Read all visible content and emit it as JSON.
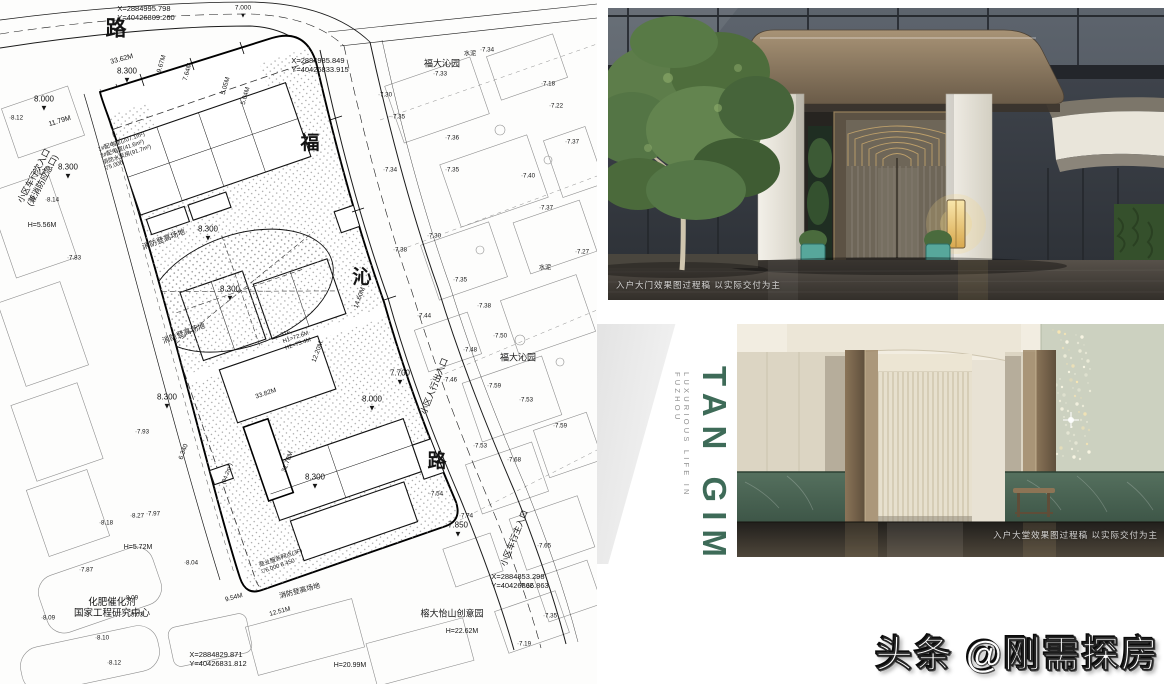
{
  "colors": {
    "brand_green": "#3E6B58",
    "canopy_bronze": "#8a7660",
    "marble_green": "#4a6454",
    "planter_teal": "#57a79b",
    "lamp_glow": "#f0d48a",
    "tree_green": "#5d7d4a"
  },
  "watermark": {
    "text": "头条 @刚需探房"
  },
  "brand": {
    "title": "TAN GIM",
    "subtitle": "LUXURIOUS LIFE IN FUZHOU"
  },
  "entrance_render": {
    "caption": "入户大门效果图过程稿 以实际交付为主"
  },
  "lobby_render": {
    "caption": "入户大堂效果图过程稿 以实际交付为主"
  },
  "site_plan": {
    "labels": [
      {
        "text": "X=2884995.798\nY=40426809.260",
        "x": 146,
        "y": 14,
        "size": 7.5,
        "align": "left"
      },
      {
        "text": "路",
        "x": 116,
        "y": 30,
        "size": 21,
        "bold": true,
        "name": "road-name-top"
      },
      {
        "text": "7.000\n▼",
        "x": 243,
        "y": 12,
        "size": 6.5
      },
      {
        "text": "小区车行次入口\n(兼消防应急口)",
        "x": 38,
        "y": 178,
        "rot": -62,
        "size": 8.5,
        "name": "entrance-secondary-vehicle"
      },
      {
        "text": "8.300\n▼",
        "x": 127,
        "y": 76,
        "size": 8
      },
      {
        "text": "8.000\n▼",
        "x": 44,
        "y": 104,
        "size": 8
      },
      {
        "text": "11.79M",
        "x": 60,
        "y": 122,
        "rot": -17,
        "size": 7
      },
      {
        "text": "33.62M",
        "x": 122,
        "y": 60,
        "rot": -15,
        "size": 7
      },
      {
        "text": "9.67M",
        "x": 162,
        "y": 64,
        "rot": -74,
        "size": 6.5
      },
      {
        "text": "7.64M",
        "x": 188,
        "y": 72,
        "rot": -74,
        "size": 6.5
      },
      {
        "text": "5.05M",
        "x": 226,
        "y": 86,
        "rot": -74,
        "size": 6.5
      },
      {
        "text": "5.04M",
        "x": 246,
        "y": 96,
        "rot": -74,
        "size": 6.5
      },
      {
        "text": "X=2884985.849\nY=40426833.915",
        "x": 320,
        "y": 66,
        "size": 7.5,
        "align": "left"
      },
      {
        "text": "福大沁园",
        "x": 442,
        "y": 64,
        "size": 9
      },
      {
        "text": "福",
        "x": 310,
        "y": 144,
        "size": 19,
        "bold": true,
        "name": "road-name-fu"
      },
      {
        "text": "沁",
        "x": 362,
        "y": 278,
        "size": 19,
        "bold": true,
        "name": "road-name-qin"
      },
      {
        "text": "路",
        "x": 437,
        "y": 462,
        "size": 19,
        "bold": true,
        "name": "road-name-lu"
      },
      {
        "text": "8.300\n▼",
        "x": 68,
        "y": 172,
        "size": 8
      },
      {
        "text": "H=5.56M",
        "x": 42,
        "y": 226,
        "size": 7
      },
      {
        "text": "1#配电室(207.1m²)\n2#配电室(41.6m²)\n消防水泵房(91.7m²)\n▽5.000",
        "x": 126,
        "y": 152,
        "rot": -19,
        "size": 5.8,
        "align": "left"
      },
      {
        "text": "消防登高场地",
        "x": 164,
        "y": 240,
        "rot": -21,
        "size": 7.5
      },
      {
        "text": "8.300\n▼",
        "x": 208,
        "y": 234,
        "size": 8
      },
      {
        "text": "8.300\n▼",
        "x": 230,
        "y": 294,
        "size": 8
      },
      {
        "text": "消防登高场地",
        "x": 184,
        "y": 334,
        "rot": -21,
        "size": 7.5
      },
      {
        "text": "31F\nH1=72.6M\nH2=73.4M",
        "x": 296,
        "y": 338,
        "rot": -19,
        "size": 5.8,
        "align": "left"
      },
      {
        "text": "14.60M",
        "x": 360,
        "y": 298,
        "rot": -70,
        "size": 6.5
      },
      {
        "text": "7.700\n▼",
        "x": 400,
        "y": 378,
        "size": 8
      },
      {
        "text": "8.000\n▼",
        "x": 372,
        "y": 404,
        "size": 8
      },
      {
        "text": "小区人行出入口",
        "x": 434,
        "y": 386,
        "rot": -68,
        "size": 8.5,
        "name": "entrance-pedestrian"
      },
      {
        "text": "12.20M",
        "x": 318,
        "y": 352,
        "rot": -70,
        "size": 6.5
      },
      {
        "text": "8.300\n▼",
        "x": 167,
        "y": 402,
        "size": 8
      },
      {
        "text": "33.82M",
        "x": 266,
        "y": 394,
        "rot": -19,
        "size": 6.5
      },
      {
        "text": "31.70M",
        "x": 288,
        "y": 462,
        "rot": -70,
        "size": 6.5
      },
      {
        "text": "6.340",
        "x": 184,
        "y": 452,
        "rot": -70,
        "size": 6.5
      },
      {
        "text": "(84.2m²)",
        "x": 228,
        "y": 474,
        "rot": -70,
        "size": 5.8
      },
      {
        "text": "8.300\n▼",
        "x": 315,
        "y": 482,
        "size": 8
      },
      {
        "text": "H=5.72M",
        "x": 138,
        "y": 548,
        "size": 7
      },
      {
        "text": "商业服务网点(3F)\n▽6.000  8.450",
        "x": 282,
        "y": 562,
        "rot": -19,
        "size": 5.8,
        "align": "left"
      },
      {
        "text": "9.54M",
        "x": 234,
        "y": 598,
        "rot": -15,
        "size": 6.5
      },
      {
        "text": "12.51M",
        "x": 280,
        "y": 612,
        "rot": -15,
        "size": 6.5
      },
      {
        "text": "消防登高场地",
        "x": 300,
        "y": 592,
        "rot": -15,
        "size": 7
      },
      {
        "text": "7.850\n▼",
        "x": 458,
        "y": 530,
        "size": 8
      },
      {
        "text": "小区车行主入口",
        "x": 514,
        "y": 538,
        "rot": -68,
        "size": 8.5,
        "name": "entrance-main-vehicle"
      },
      {
        "text": "X=2884853.298\nY=40426866.863",
        "x": 520,
        "y": 582,
        "size": 7.5,
        "align": "left"
      },
      {
        "text": "福大沁园",
        "x": 518,
        "y": 358,
        "size": 9
      },
      {
        "text": "榕大怡山创意园",
        "x": 452,
        "y": 614,
        "size": 9
      },
      {
        "text": "H=22.62M",
        "x": 462,
        "y": 632,
        "size": 7
      },
      {
        "text": "H=20.99M",
        "x": 350,
        "y": 666,
        "size": 7
      },
      {
        "text": "化肥催化剂\n国家工程研究中心",
        "x": 112,
        "y": 608,
        "size": 9.5,
        "name": "research-center-label"
      },
      {
        "text": "X=2884829.871\nY=40426831.812",
        "x": 218,
        "y": 660,
        "size": 7.5,
        "align": "left"
      },
      {
        "text": "水泥",
        "x": 470,
        "y": 54,
        "size": 6.2
      },
      {
        "text": "水泥",
        "x": 545,
        "y": 268,
        "size": 6.2
      },
      {
        "text": "·7.30",
        "x": 385,
        "y": 95,
        "size": 6.2
      },
      {
        "text": "·7.35",
        "x": 398,
        "y": 117,
        "size": 6.2
      },
      {
        "text": "·7.34",
        "x": 390,
        "y": 170,
        "size": 6.2
      },
      {
        "text": "·7.33",
        "x": 440,
        "y": 74,
        "size": 6.2
      },
      {
        "text": "·7.34",
        "x": 487,
        "y": 50,
        "size": 6.2
      },
      {
        "text": "·7.18",
        "x": 548,
        "y": 84,
        "size": 6.2
      },
      {
        "text": "·7.22",
        "x": 556,
        "y": 106,
        "size": 6.2
      },
      {
        "text": "·7.37",
        "x": 572,
        "y": 142,
        "size": 6.2
      },
      {
        "text": "·7.40",
        "x": 528,
        "y": 176,
        "size": 6.2
      },
      {
        "text": "·7.35",
        "x": 452,
        "y": 170,
        "size": 6.2
      },
      {
        "text": "·7.36",
        "x": 452,
        "y": 138,
        "size": 6.2
      },
      {
        "text": "·7.37",
        "x": 546,
        "y": 208,
        "size": 6.2
      },
      {
        "text": "·7.27",
        "x": 582,
        "y": 252,
        "size": 6.2
      },
      {
        "text": "·7.30",
        "x": 434,
        "y": 236,
        "size": 6.2
      },
      {
        "text": "·7.38",
        "x": 400,
        "y": 250,
        "size": 6.2
      },
      {
        "text": "·7.35",
        "x": 460,
        "y": 280,
        "size": 6.2
      },
      {
        "text": "·7.38",
        "x": 484,
        "y": 306,
        "size": 6.2
      },
      {
        "text": "·7.44",
        "x": 424,
        "y": 316,
        "size": 6.2
      },
      {
        "text": "·7.50",
        "x": 500,
        "y": 336,
        "size": 6.2
      },
      {
        "text": "·7.48",
        "x": 470,
        "y": 350,
        "size": 6.2
      },
      {
        "text": "·7.46",
        "x": 450,
        "y": 380,
        "size": 6.2
      },
      {
        "text": "·7.59",
        "x": 494,
        "y": 386,
        "size": 6.2
      },
      {
        "text": "·7.53",
        "x": 526,
        "y": 400,
        "size": 6.2
      },
      {
        "text": "·7.59",
        "x": 560,
        "y": 426,
        "size": 6.2
      },
      {
        "text": "·7.53",
        "x": 480,
        "y": 446,
        "size": 6.2
      },
      {
        "text": "·7.68",
        "x": 514,
        "y": 460,
        "size": 6.2
      },
      {
        "text": "·7.54",
        "x": 436,
        "y": 494,
        "size": 6.2
      },
      {
        "text": "·7.74",
        "x": 466,
        "y": 516,
        "size": 6.2
      },
      {
        "text": "·7.65",
        "x": 544,
        "y": 546,
        "size": 6.2
      },
      {
        "text": "·7.32",
        "x": 526,
        "y": 586,
        "size": 6.2
      },
      {
        "text": "·7.35",
        "x": 550,
        "y": 616,
        "size": 6.2
      },
      {
        "text": "·7.19",
        "x": 524,
        "y": 644,
        "size": 6.2
      },
      {
        "text": "·8.13",
        "x": 38,
        "y": 172,
        "size": 6.2
      },
      {
        "text": "·8.14",
        "x": 52,
        "y": 200,
        "size": 6.2
      },
      {
        "text": "·7.83",
        "x": 74,
        "y": 258,
        "size": 6.2
      },
      {
        "text": "·8.12",
        "x": 16,
        "y": 118,
        "size": 6.2
      },
      {
        "text": "·7.93",
        "x": 142,
        "y": 432,
        "size": 6.2
      },
      {
        "text": "·8.27",
        "x": 137,
        "y": 516,
        "size": 6.2
      },
      {
        "text": "·7.97",
        "x": 153,
        "y": 514,
        "size": 6.2
      },
      {
        "text": "·8.18",
        "x": 106,
        "y": 523,
        "size": 6.2
      },
      {
        "text": "·8.04",
        "x": 191,
        "y": 563,
        "size": 6.2
      },
      {
        "text": "·7.87",
        "x": 86,
        "y": 570,
        "size": 6.2
      },
      {
        "text": "·8.09",
        "x": 131,
        "y": 598,
        "size": 6.2
      },
      {
        "text": "·8.10",
        "x": 102,
        "y": 638,
        "size": 6.2
      },
      {
        "text": "·8.12",
        "x": 114,
        "y": 663,
        "size": 6.2
      },
      {
        "text": "·8.09",
        "x": 48,
        "y": 618,
        "size": 6.2
      },
      {
        "text": "·8.03",
        "x": 136,
        "y": 615,
        "size": 6.2
      }
    ]
  }
}
